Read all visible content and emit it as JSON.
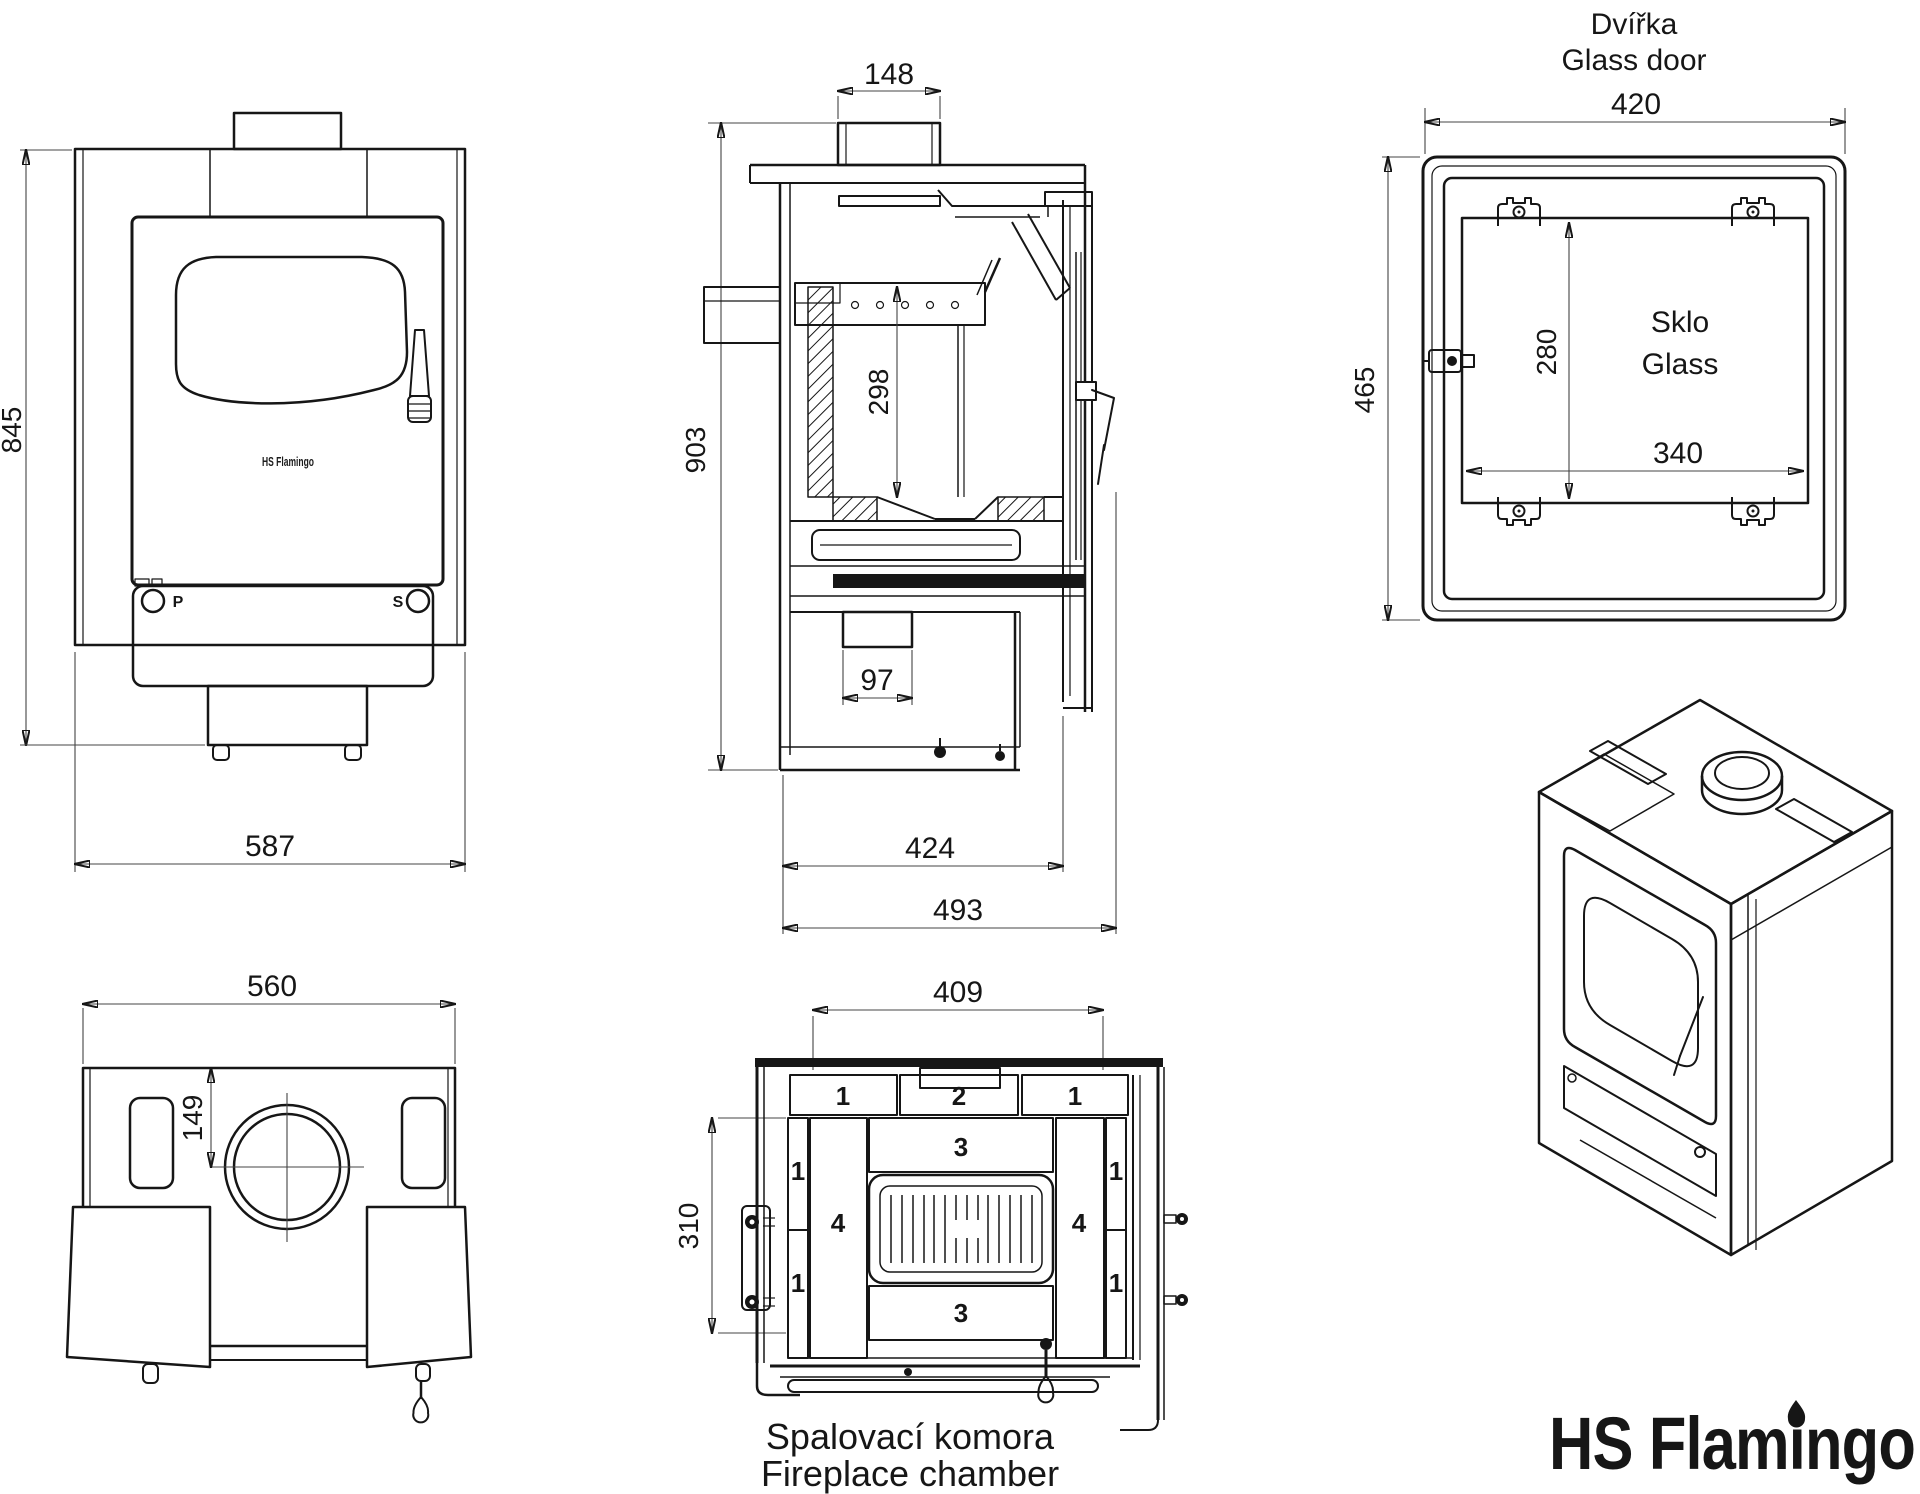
{
  "brand": {
    "logo_text": "HS Flamingo",
    "logo_color": "#de1a21"
  },
  "views": {
    "front": {
      "dims": {
        "height": "845",
        "width": "587"
      },
      "knob_left": "P",
      "knob_right": "S",
      "door_logo": "HS Flamingo"
    },
    "section": {
      "dims": {
        "flue_width": "148",
        "height": "903",
        "firebox_height": "298",
        "outlet_width": "97",
        "inner_depth": "424",
        "depth": "493"
      }
    },
    "glass_door": {
      "title_cs": "Dvířka",
      "title_en": "Glass door",
      "glass_cs": "Sklo",
      "glass_en": "Glass",
      "dims": {
        "width": "420",
        "height": "465",
        "glass_height": "280",
        "glass_width": "340"
      }
    },
    "top": {
      "dims": {
        "width": "560",
        "flue_center": "149"
      }
    },
    "chamber": {
      "caption_cs": "Spalovací komora",
      "caption_en": "Fireplace chamber",
      "dims": {
        "width": "409",
        "height": "310"
      },
      "parts": {
        "p1": "1",
        "p2": "2",
        "p3": "3",
        "p4": "4"
      }
    }
  }
}
